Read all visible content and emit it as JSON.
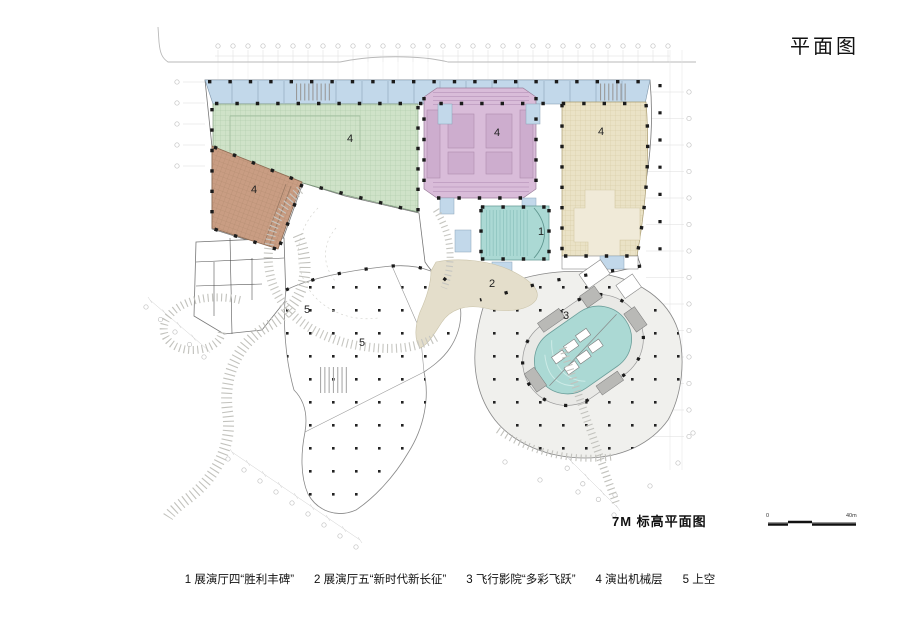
{
  "title": "平面图",
  "caption": "7M 标高平面图",
  "scale_bar": {
    "start": "0",
    "end": "40m"
  },
  "legend": {
    "items": [
      "1  展演厅四“胜利丰碑”",
      "2  展演厅五“新时代新长征”",
      "3  飞行影院“多彩飞跃”",
      "4  演出机械层",
      "5  上空"
    ]
  },
  "plan": {
    "labels": [
      {
        "id": "hall-green",
        "text": "4"
      },
      {
        "id": "hall-purple",
        "text": "4"
      },
      {
        "id": "hall-tan",
        "text": "4"
      },
      {
        "id": "hall-brown",
        "text": "4"
      },
      {
        "id": "theater-1",
        "text": "1"
      },
      {
        "id": "hall-2",
        "text": "2"
      },
      {
        "id": "flying-theater-3",
        "text": "3"
      },
      {
        "id": "void-5a",
        "text": "5"
      },
      {
        "id": "void-5b",
        "text": "5"
      }
    ]
  },
  "colors": {
    "hall_green": "#cfe2c8",
    "hall_purple": "#d9bcd9",
    "hall_tan": "#eae2c6",
    "hall_brown": "#c99d83",
    "corridor_blue": "#c2d8ea",
    "theater_teal": "#abd9d4",
    "hall_beige": "#e4decb",
    "walkway_gray": "#f0f0ed"
  }
}
